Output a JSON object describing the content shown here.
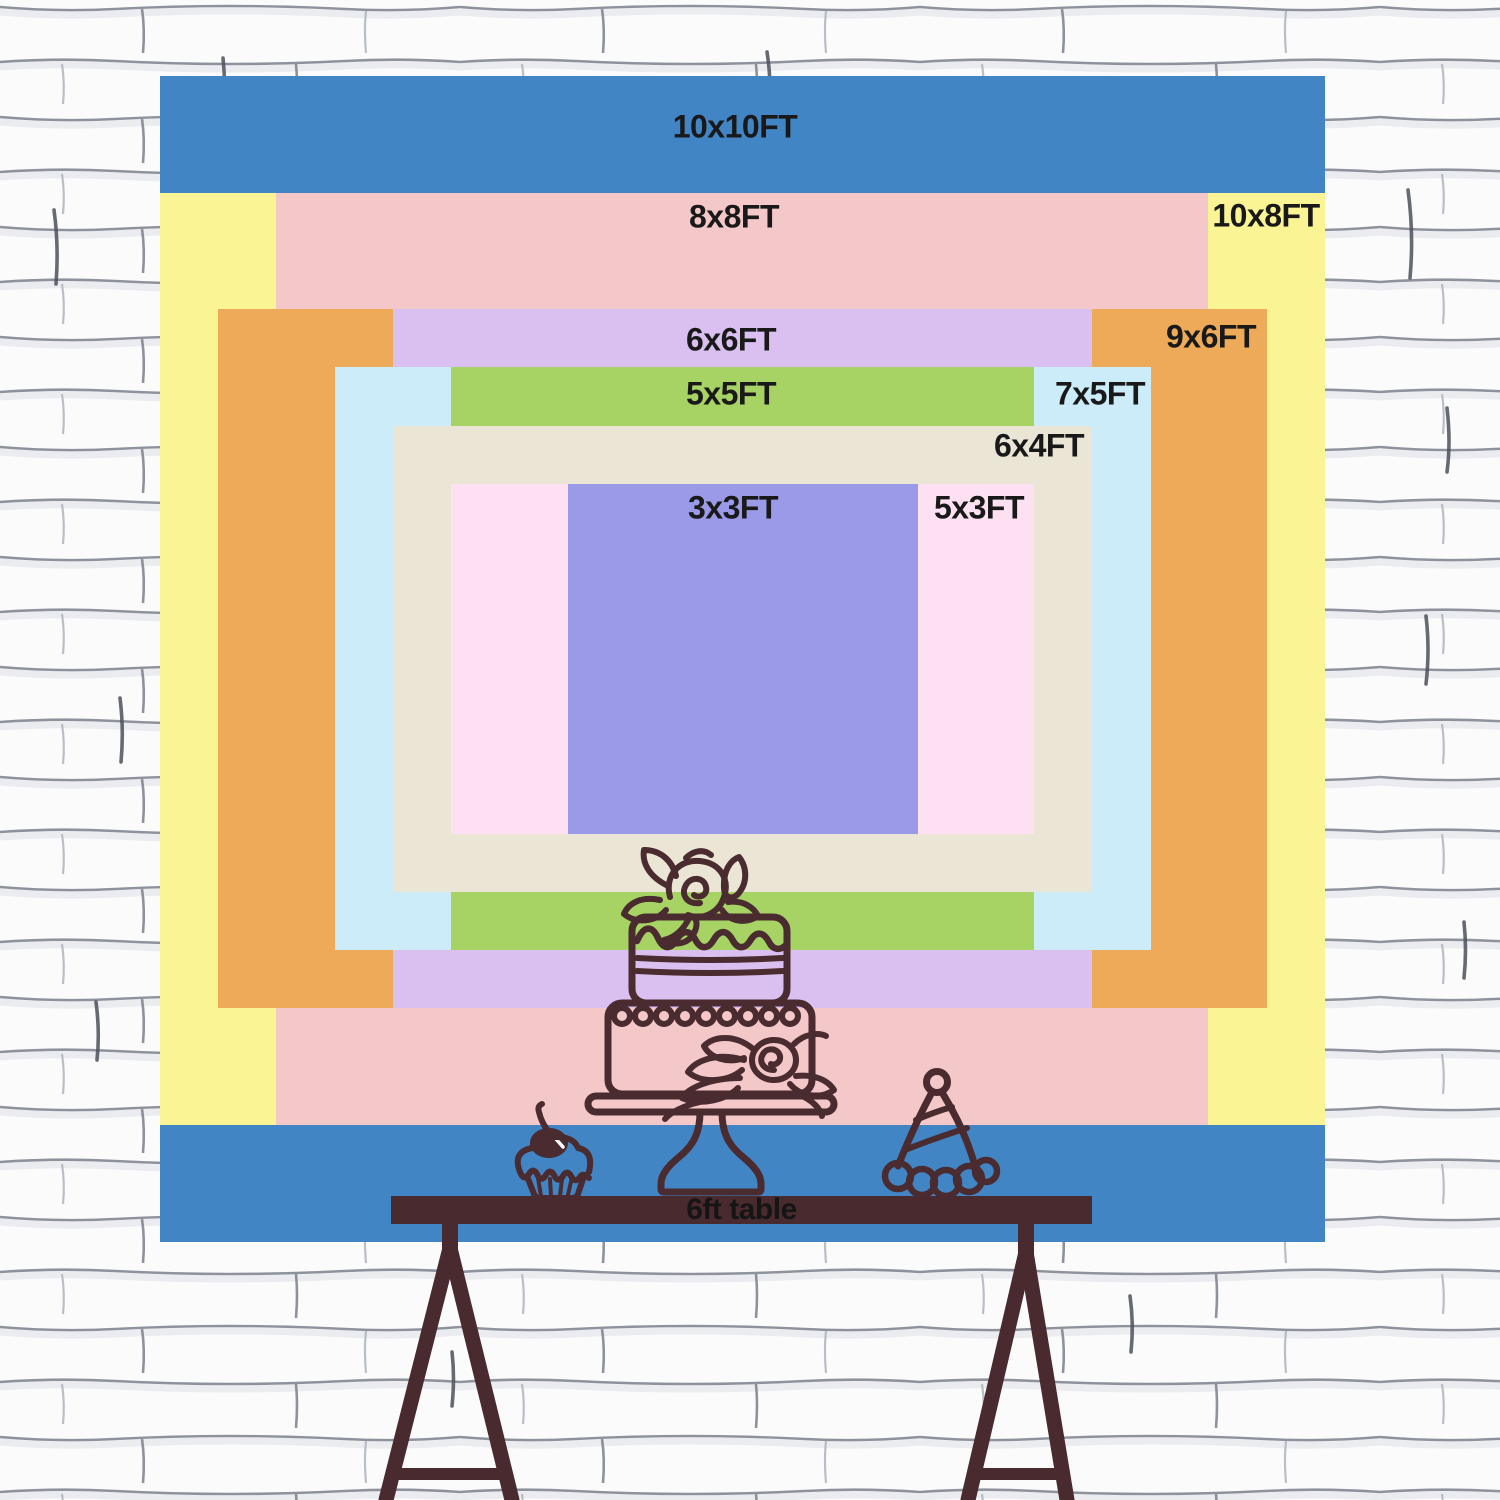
{
  "sizes": [
    {
      "label": "10x10FT",
      "width_ft": 10,
      "height_ft": 10,
      "color": "#4285c5"
    },
    {
      "label": "10x8FT",
      "width_ft": 10,
      "height_ft": 8,
      "color": "#faf494"
    },
    {
      "label": "8x8FT",
      "width_ft": 8,
      "height_ft": 8,
      "color": "#f4c8c9"
    },
    {
      "label": "9x6FT",
      "width_ft": 9,
      "height_ft": 6,
      "color": "#edaa58"
    },
    {
      "label": "6x6FT",
      "width_ft": 6,
      "height_ft": 6,
      "color": "#d9c0f0"
    },
    {
      "label": "7x5FT",
      "width_ft": 7,
      "height_ft": 5,
      "color": "#cbecf8"
    },
    {
      "label": "5x5FT",
      "width_ft": 5,
      "height_ft": 5,
      "color": "#a7d364"
    },
    {
      "label": "6x4FT",
      "width_ft": 6,
      "height_ft": 4,
      "color": "#ebe5d6"
    },
    {
      "label": "5x3FT",
      "width_ft": 5,
      "height_ft": 3,
      "color": "#fde1f2"
    },
    {
      "label": "3x3FT",
      "width_ft": 3,
      "height_ft": 3,
      "color": "#9b9ae9"
    }
  ],
  "label_text_color": "#191919",
  "table": {
    "label": "6ft table",
    "surface_color": "#492a2e",
    "text_color": "#151515"
  },
  "illustration": {
    "line_color": "#4a2b30",
    "highlight_color": "#ffffff",
    "items": [
      "two-tier-cake",
      "cupcake-with-cherry",
      "party-hat"
    ]
  },
  "wall": {
    "base_color": "#fbfbfc",
    "mortar_color": "#7a808b",
    "accent_color": "#4b505b"
  }
}
